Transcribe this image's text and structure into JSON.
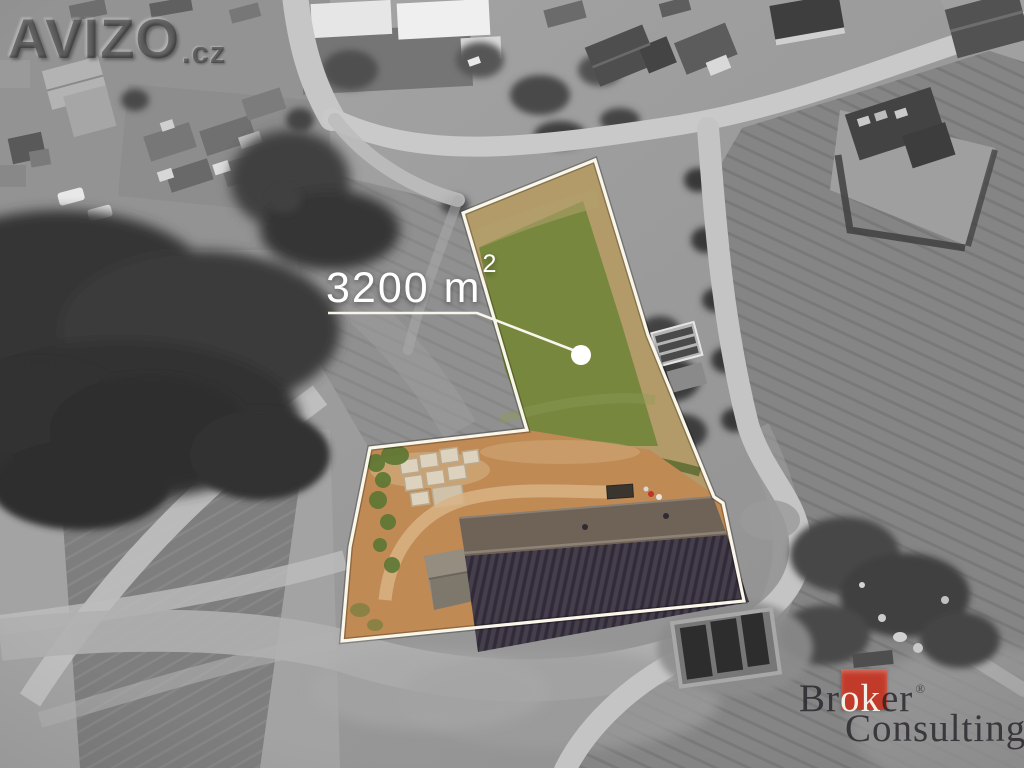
{
  "watermark": {
    "brand": "AVIZO",
    "suffix": ".cz"
  },
  "area_label": {
    "text": "3200 m",
    "superscript": "2"
  },
  "marker": {
    "dot_color": "#ffffff",
    "line_color": "#f8f6ec"
  },
  "boundary": {
    "stroke_color": "#faf7ea"
  },
  "plot_colors": {
    "grass_tan": "#b29b68",
    "grass_green": "#77883e",
    "dirt_orange": "#c08a55",
    "roof_upper": "#6f6358",
    "roof_lower": "#453e4b"
  },
  "logo": {
    "word1_pre": "Br",
    "word1_mid": "ok",
    "word1_post": "er",
    "registered": "®",
    "word2": "Consulting",
    "square_color": "#c23b2a"
  }
}
